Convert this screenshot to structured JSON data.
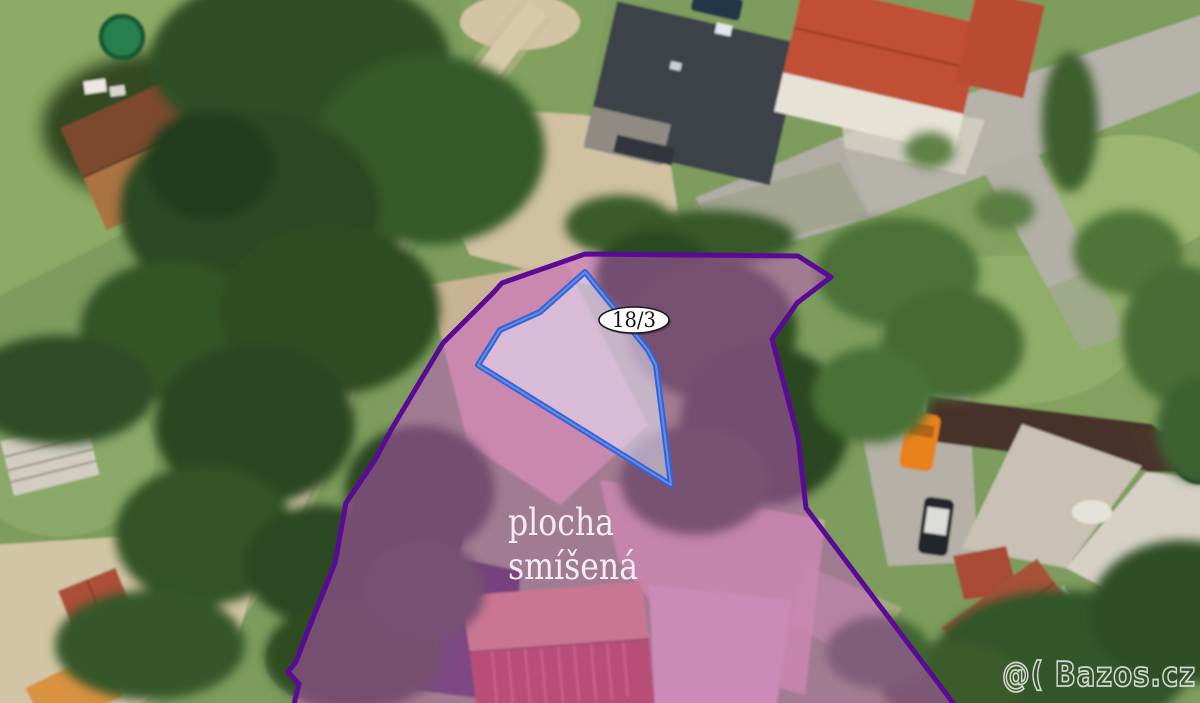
{
  "map": {
    "zone": {
      "label_line1": "plocha",
      "label_line2": "smíšená"
    },
    "parcel": {
      "number": "18/3"
    },
    "watermark": {
      "text": "@( Bazos.cz"
    },
    "colors": {
      "zone_boundary": "#5a0b96",
      "zone_fill": "rgba(207,85,209,0.45)",
      "parcel_stroke": "#3363d6",
      "parcel_inner_stroke": "#7aa0ea",
      "parcel_fill": "rgba(230,228,248,0.55)",
      "parcel_badge_bg": "#ffffff",
      "parcel_badge_border": "#1a1a1a",
      "parcel_badge_text": "#111111",
      "zone_label_color": "#f3ecf3",
      "watermark_color": "#ededed"
    }
  }
}
